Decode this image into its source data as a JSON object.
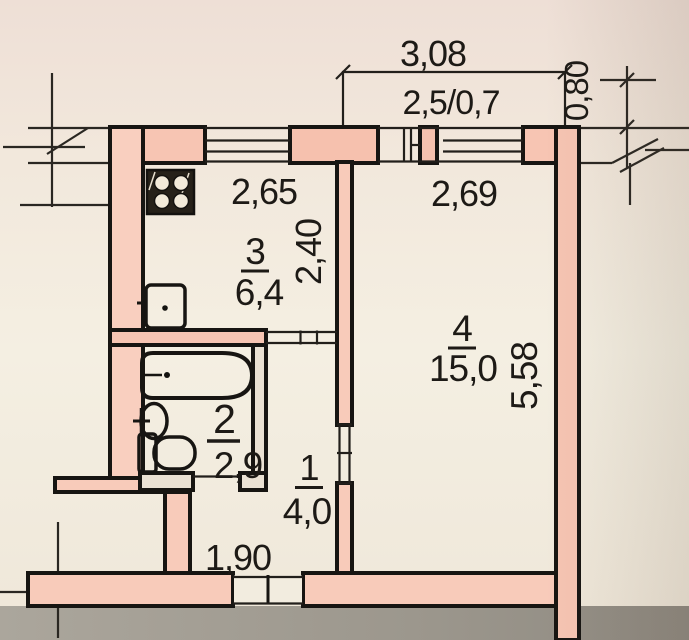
{
  "plan_type": "apartment-floor-plan",
  "colors": {
    "wall_fill": "#f7c5b3",
    "wall_fill_light": "#f9cfbf",
    "line": "#171512",
    "paper": "#f3ebde",
    "outside_strip": "#9c978d"
  },
  "rooms": {
    "hall": {
      "number": "1",
      "area": "4,0"
    },
    "bath": {
      "number": "2",
      "area": "2,9"
    },
    "kitchen": {
      "number": "3",
      "area": "6,4"
    },
    "living": {
      "number": "4",
      "area": "15,0"
    }
  },
  "dimensions": {
    "balcony_width": "3,08",
    "balcony_size": "2,5/0,7",
    "balcony_depth": "0,80",
    "kitchen_width": "2,65",
    "kitchen_depth": "2,40",
    "living_width": "2,69",
    "living_depth": "5,58",
    "hall_width": "1,90"
  },
  "fixtures": {
    "stove": "stove-icon",
    "kitchen_sink": "kitchen-sink-icon",
    "bathtub": "bathtub-icon",
    "washbasin": "washbasin-icon",
    "toilet": "toilet-icon"
  }
}
